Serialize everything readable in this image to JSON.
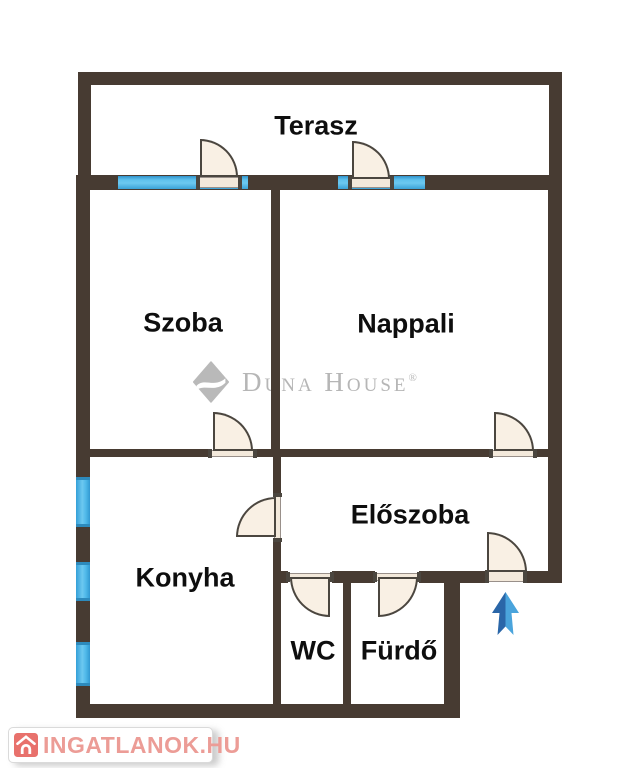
{
  "plan": {
    "type": "apartment-floor-plan",
    "rooms": {
      "terasz": {
        "label": "Terasz"
      },
      "szoba": {
        "label": "Szoba"
      },
      "nappali": {
        "label": "Nappali"
      },
      "eloszoba": {
        "label": "Előszoba"
      },
      "konyha": {
        "label": "Konyha"
      },
      "wc": {
        "label": "WC"
      },
      "furdo": {
        "label": "Fürdő"
      }
    },
    "icons": {
      "entrance_arrow": "up-arrow",
      "doors": "quarter-circle-swing-door",
      "windows": "blue-wall-segment"
    },
    "colors": {
      "wall": "#473b32",
      "window_blue": "#4fb9e9",
      "door_fill": "#f9f0e4",
      "arrow_dark_blue": "#2a66a8",
      "arrow_light_blue": "#4aa4dc"
    }
  },
  "watermarks": {
    "duna_house": {
      "brand": "Duna House",
      "registered": "®",
      "logo": "diamond-swoosh",
      "color": "#b6b6b6"
    },
    "ingatlanok": {
      "brand": "INGATLANOK.HU",
      "logo": "house-in-red-square",
      "icon_color": "#e8716c",
      "text_color": "#ec9c96"
    }
  }
}
